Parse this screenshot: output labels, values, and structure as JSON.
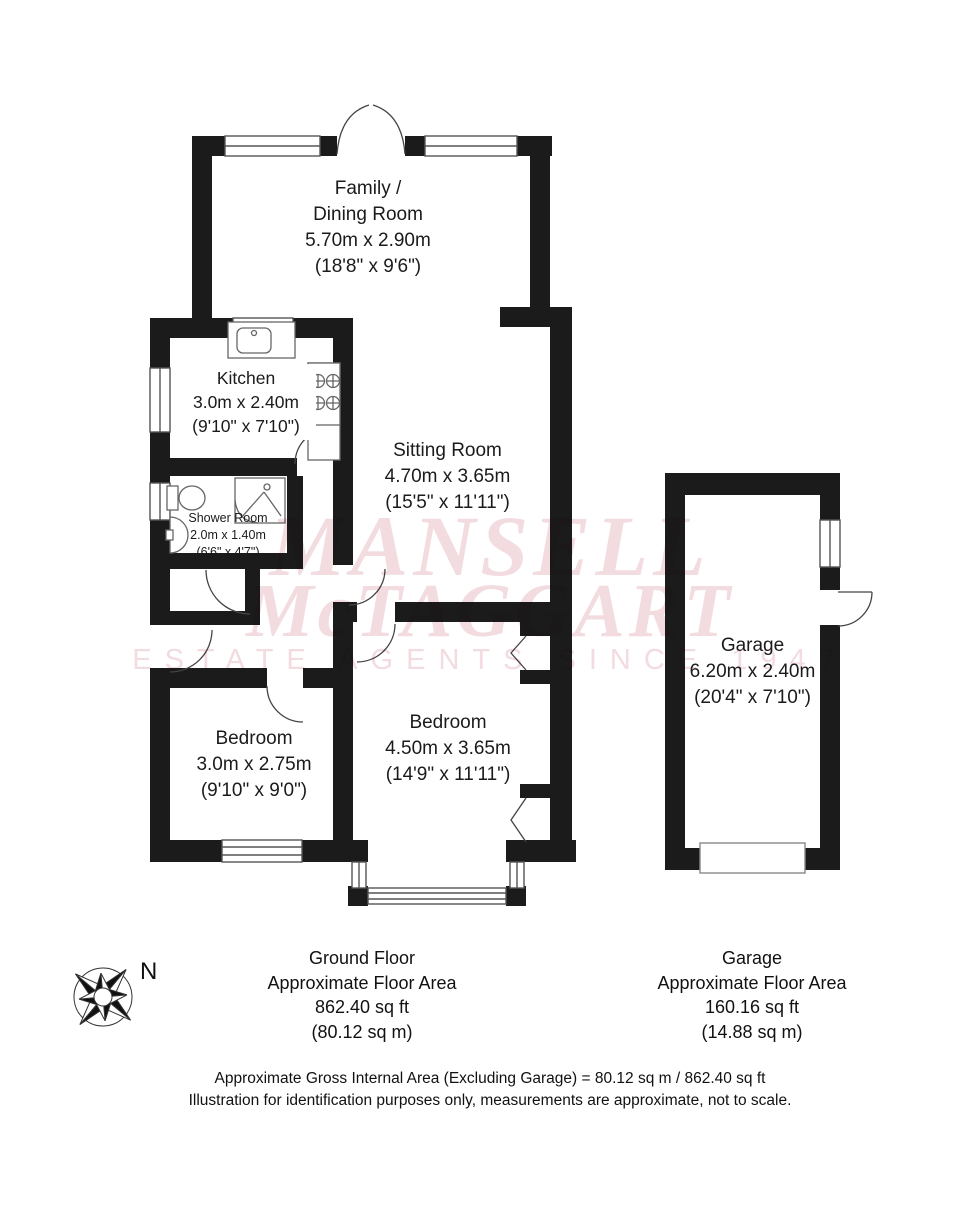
{
  "watermark": {
    "line1": "MANSELL",
    "line2": "McTAGGART",
    "line3": "ESTATE AGENTS SINCE 1947",
    "color": "#f2dce0"
  },
  "colors": {
    "wall": "#1b1b1b",
    "fixture_stroke": "#666666"
  },
  "compass": {
    "label": "N"
  },
  "rooms": {
    "family_dining": {
      "lines": [
        "Family /",
        "Dining Room",
        "5.70m x 2.90m",
        "(18'8\" x 9'6\")"
      ]
    },
    "kitchen": {
      "lines": [
        "Kitchen",
        "3.0m x 2.40m",
        "(9'10\" x 7'10\")"
      ]
    },
    "sitting": {
      "lines": [
        "Sitting Room",
        "4.70m x 3.65m",
        "(15'5\" x 11'11\")"
      ]
    },
    "shower": {
      "lines": [
        "Shower Room",
        "2.0m x 1.40m",
        "(6'6\" x 4'7\")"
      ]
    },
    "bedroom1": {
      "lines": [
        "Bedroom",
        "3.0m x 2.75m",
        "(9'10\" x 9'0\")"
      ]
    },
    "bedroom2": {
      "lines": [
        "Bedroom",
        "4.50m x 3.65m",
        "(14'9\" x 11'11\")"
      ]
    },
    "garage": {
      "lines": [
        "Garage",
        "6.20m x 2.40m",
        "(20'4\" x 7'10\")"
      ]
    }
  },
  "area_summaries": {
    "ground_floor": {
      "lines": [
        "Ground Floor",
        "Approximate Floor Area",
        "862.40 sq ft",
        "(80.12 sq m)"
      ]
    },
    "garage": {
      "lines": [
        "Garage",
        "Approximate Floor Area",
        "160.16 sq ft",
        "(14.88 sq m)"
      ]
    }
  },
  "footer": {
    "line1": "Approximate Gross Internal Area (Excluding Garage) = 80.12 sq m / 862.40 sq ft",
    "line2": "Illustration for identification purposes only, measurements are approximate, not to scale."
  }
}
